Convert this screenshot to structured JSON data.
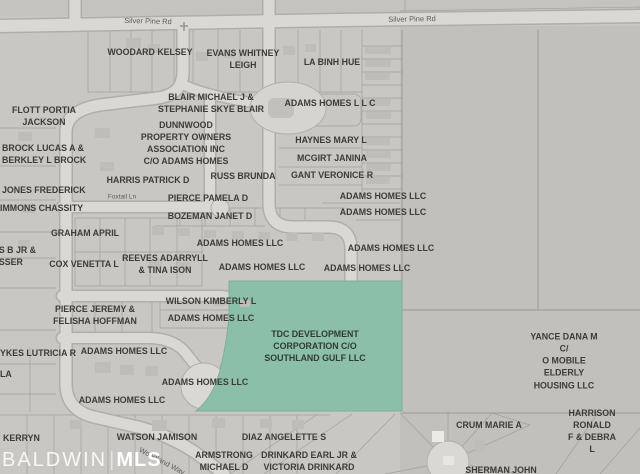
{
  "map": {
    "watermark": {
      "brand": "BALDWIN",
      "divider": "|",
      "suffix": "MLS"
    },
    "colors": {
      "highlight_fill": "#8cbfa9",
      "highlight_stroke": "#7fae99",
      "map_background": "#c9c7c3",
      "road_fill": "#dad8d4",
      "parcel_line": "#a2a09c",
      "label_text": "#3c3b39"
    },
    "road_labels": [
      {
        "label": "Silver Pine Rd",
        "x": 148,
        "y": 21,
        "rotate": 1.5,
        "size": 7.5
      },
      {
        "label": "Silver Pine Rd",
        "x": 412,
        "y": 19,
        "rotate": -1,
        "size": 7.5
      },
      {
        "label": "Silver Pine Rd",
        "x": 668,
        "y": 12,
        "rotate": -1,
        "size": 7.5
      },
      {
        "label": "Foxtail Ln",
        "x": 122,
        "y": 197,
        "rotate": 0,
        "size": 6.5
      },
      {
        "label": "Woodland Way",
        "x": 162,
        "y": 461,
        "rotate": 28,
        "size": 7.5
      }
    ],
    "highlighted_parcel_owner": "TDC DEVELOPMENT CORPORATION C/O SOUTHLAND GULF LLC",
    "parcels": [
      {
        "label": "WOODARD KELSEY",
        "x": 150,
        "y": 52
      },
      {
        "label": "EVANS WHITNEY\nLEIGH",
        "x": 243,
        "y": 59
      },
      {
        "label": "LA BINH HUE",
        "x": 332,
        "y": 62
      },
      {
        "label": "BLAIR MICHAEL J &\nSTEPHANIE SKYE BLAIR",
        "x": 211,
        "y": 103
      },
      {
        "label": "ADAMS HOMES L L C",
        "x": 330,
        "y": 103
      },
      {
        "label": "FLOTT PORTIA\nJACKSON",
        "x": 44,
        "y": 116
      },
      {
        "label": "DUNNWOOD\nPROPERTY OWNERS\nASSOCIATION INC\nC/O ADAMS HOMES",
        "x": 186,
        "y": 143
      },
      {
        "label": "HAYNES MARY L",
        "x": 331,
        "y": 140
      },
      {
        "label": "BROCK LUCAS A &\nBERKLEY L BROCK",
        "x": 2,
        "y": 154,
        "align": "l"
      },
      {
        "label": "MCGIRT JANINA",
        "x": 332,
        "y": 158
      },
      {
        "label": "GANT VERONICE R",
        "x": 332,
        "y": 175
      },
      {
        "label": "RUSS BRUNDA",
        "x": 243,
        "y": 176
      },
      {
        "label": "HARRIS PATRICK D",
        "x": 148,
        "y": 180
      },
      {
        "label": "JONES FREDERICK",
        "x": 2,
        "y": 190,
        "align": "l"
      },
      {
        "label": "ADAMS HOMES LLC",
        "x": 383,
        "y": 196
      },
      {
        "label": "PIERCE PAMELA D",
        "x": 208,
        "y": 198
      },
      {
        "label": "IMMONS CHASSITY",
        "x": 0,
        "y": 208,
        "align": "l"
      },
      {
        "label": "ADAMS HOMES LLC",
        "x": 383,
        "y": 212
      },
      {
        "label": "BOZEMAN JANET D",
        "x": 210,
        "y": 216
      },
      {
        "label": "GRAHAM APRIL",
        "x": 85,
        "y": 233
      },
      {
        "label": "ADAMS HOMES LLC",
        "x": 240,
        "y": 243
      },
      {
        "label": "ADAMS HOMES LLC",
        "x": 391,
        "y": 248
      },
      {
        "label": "ES B JR &\nESSER",
        "x": -7,
        "y": 256,
        "align": "l"
      },
      {
        "label": "COX VENETTA L",
        "x": 84,
        "y": 264
      },
      {
        "label": "REEVES ADARRYLL\n& TINA ISON",
        "x": 165,
        "y": 264
      },
      {
        "label": "ADAMS HOMES LLC",
        "x": 262,
        "y": 267
      },
      {
        "label": "ADAMS HOMES LLC",
        "x": 367,
        "y": 268
      },
      {
        "label": "WILSON KIMBERLY L",
        "x": 211,
        "y": 301
      },
      {
        "label": "PIERCE JEREMY &\nFELISHA HOFFMAN",
        "x": 95,
        "y": 315
      },
      {
        "label": "ADAMS HOMES LLC",
        "x": 211,
        "y": 318
      },
      {
        "label": "TDC DEVELOPMENT\nCORPORATION C/O\nSOUTHLAND GULF LLC",
        "x": 315,
        "y": 346,
        "highlight": true
      },
      {
        "label": "YKES LUTRICIA R",
        "x": 0,
        "y": 353,
        "align": "l"
      },
      {
        "label": "ADAMS HOMES LLC",
        "x": 124,
        "y": 351
      },
      {
        "label": "YANCE DANA M C/\nO MOBILE ELDERLY\nHOUSING LLC",
        "x": 564,
        "y": 361
      },
      {
        "label": "LA",
        "x": 0,
        "y": 374,
        "align": "l"
      },
      {
        "label": "ADAMS HOMES LLC",
        "x": 205,
        "y": 382
      },
      {
        "label": "ADAMS HOMES LLC",
        "x": 122,
        "y": 400
      },
      {
        "label": "CRUM MARIE A",
        "x": 489,
        "y": 425
      },
      {
        "label": "HARRISON RONALD\nF & DEBRA L",
        "x": 592,
        "y": 431
      },
      {
        "label": "KERRYN",
        "x": 3,
        "y": 438,
        "align": "l"
      },
      {
        "label": "WATSON JAMISON",
        "x": 157,
        "y": 437
      },
      {
        "label": "DIAZ ANGELETTE S",
        "x": 284,
        "y": 437
      },
      {
        "label": "ARMSTRONG\nMICHAEL D",
        "x": 224,
        "y": 461
      },
      {
        "label": "DRINKARD EARL JR &\nVICTORIA DRINKARD",
        "x": 309,
        "y": 461
      },
      {
        "label": "SHERMAN JOHN",
        "x": 501,
        "y": 470
      }
    ]
  }
}
